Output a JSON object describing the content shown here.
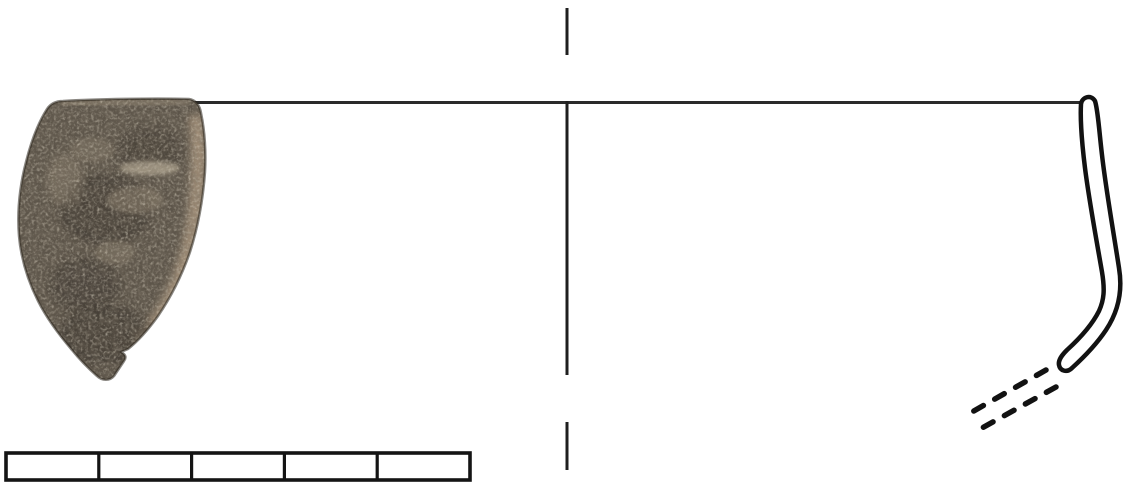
{
  "figure": {
    "kind": "archaeological-rim-sherd-illustration",
    "background_color": "#ffffff",
    "ink_color": "#1f1f1f",
    "sherd_photo": {
      "label": "pottery-rim-sherd-photograph",
      "base_color": "#5d554a",
      "dark_patch_color": "#3b352d",
      "light_patch_color": "#8f8371",
      "edge_highlight_color": "#a6937b",
      "streak_color": "#c9bda6"
    },
    "rim_line": {
      "color": "#2a2a2a"
    },
    "center_axis": {
      "color": "#1f1f1f",
      "segment_count": 3
    },
    "rim_profile": {
      "fill_color": "#ffffff",
      "stroke_color": "#121212"
    },
    "projection_dashes": {
      "color": "#121212",
      "line_count": 2
    },
    "scale_bar": {
      "border_color": "#141414",
      "fill_color": "#ffffff",
      "segment_count": 5
    }
  }
}
